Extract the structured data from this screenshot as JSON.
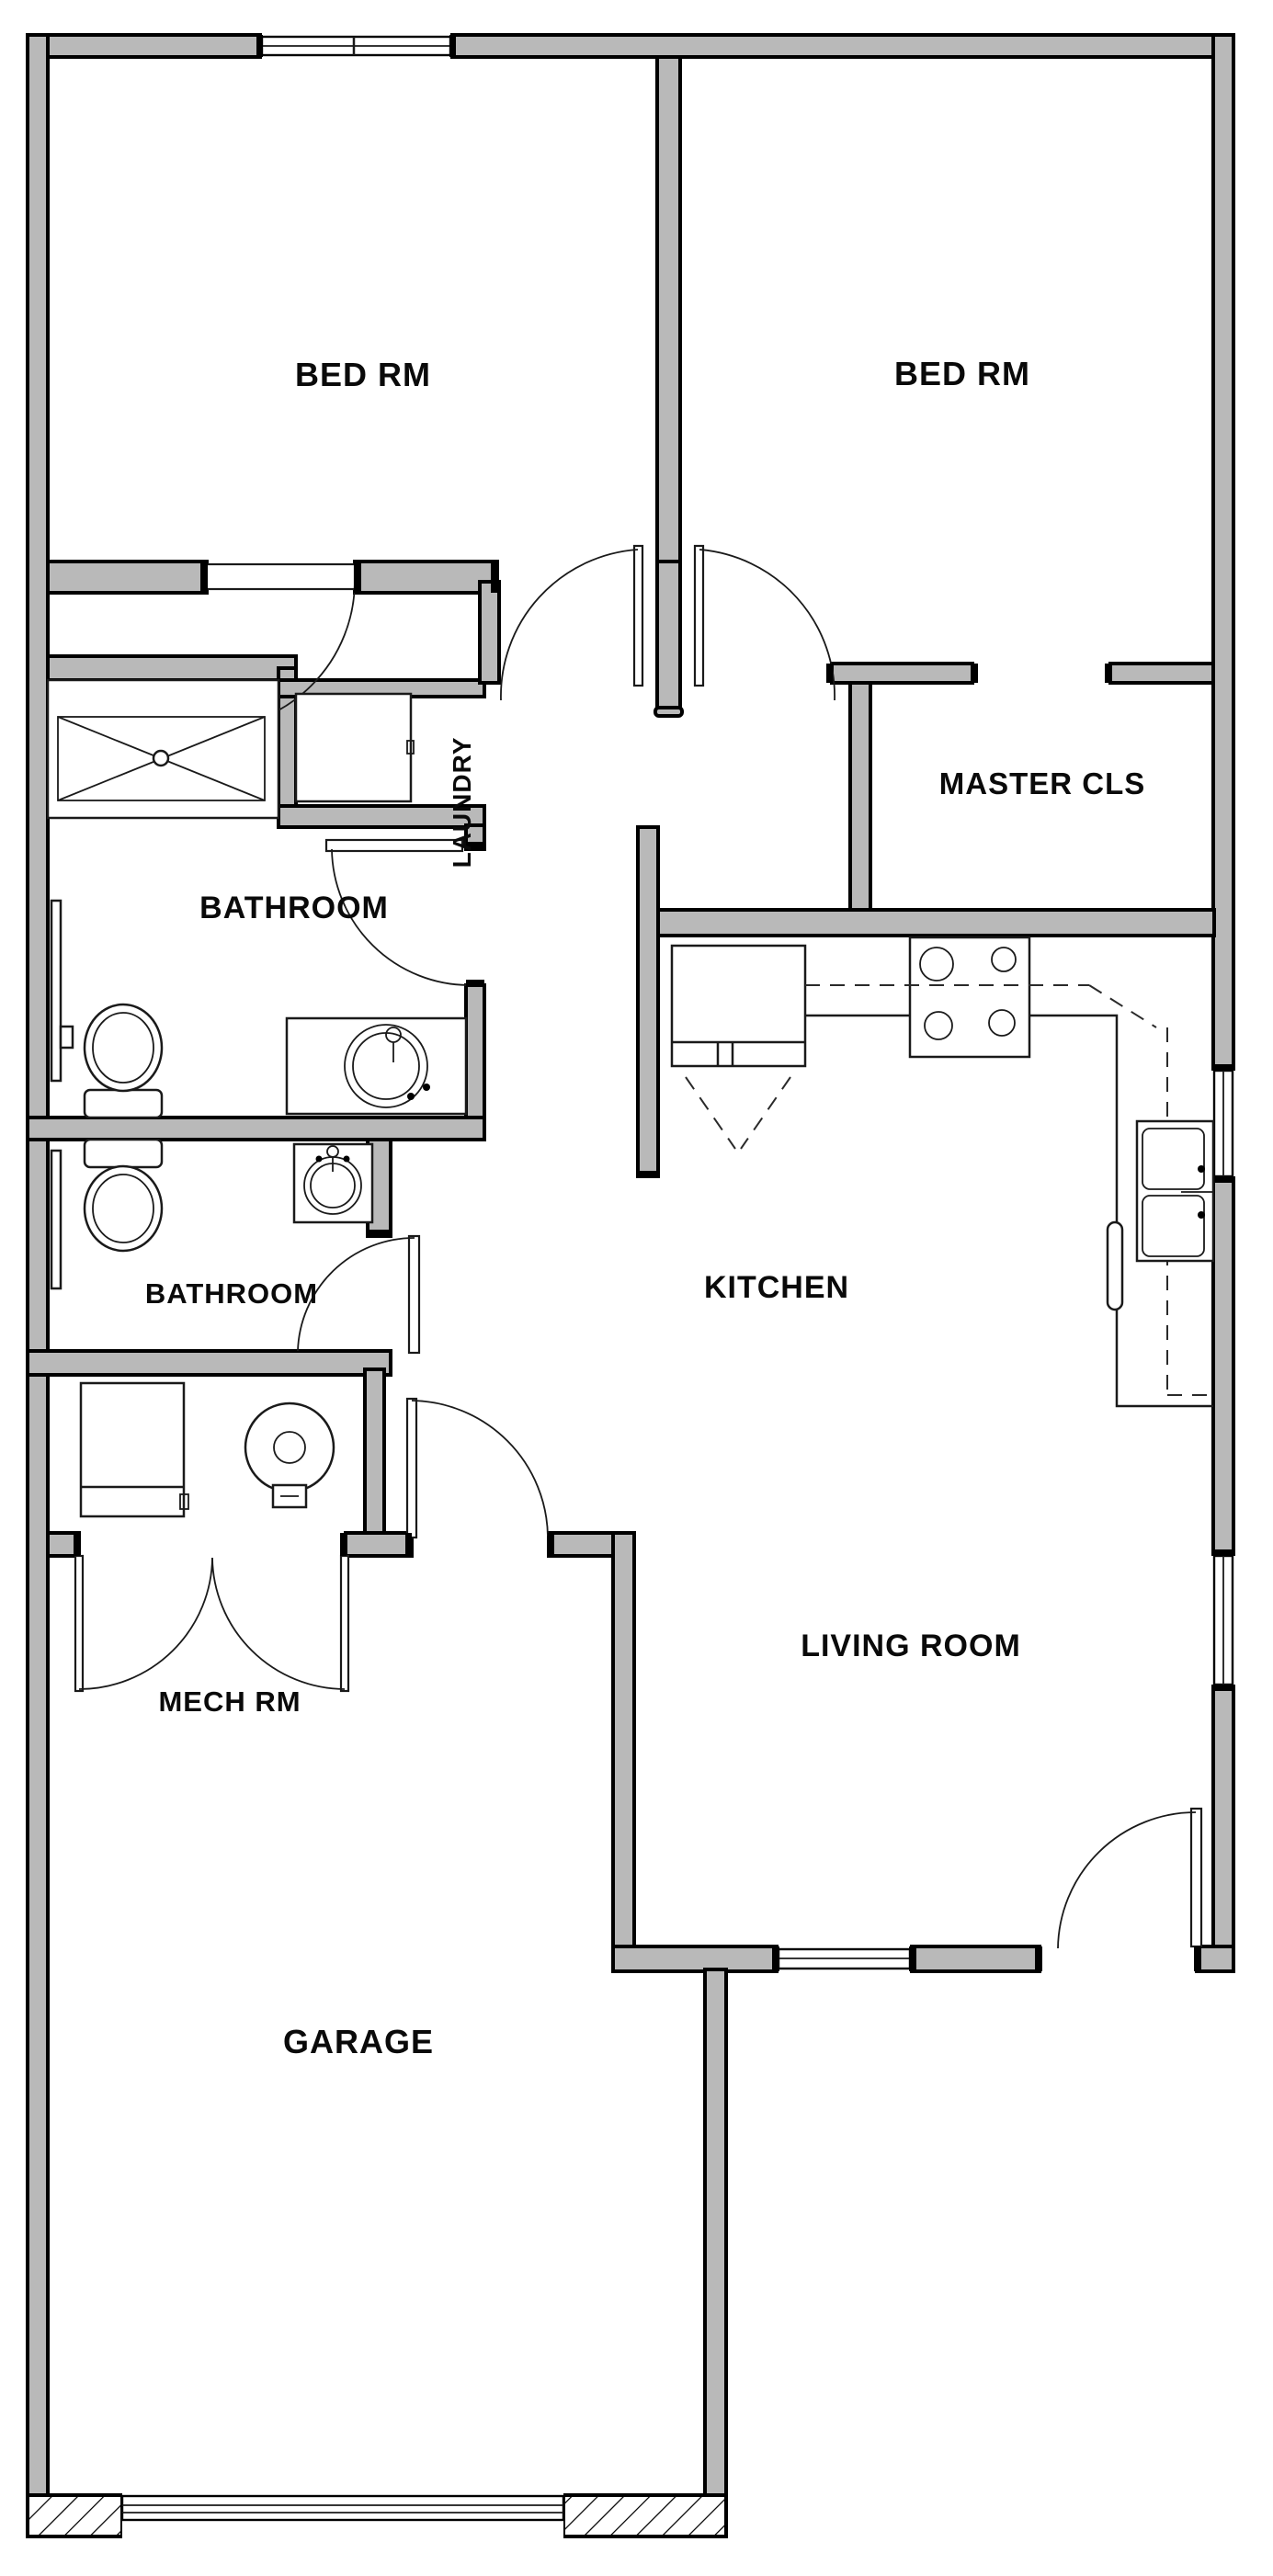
{
  "title": "Residential unit floor plan",
  "colors": {
    "wall_fill": "#b9b9b9",
    "wall_line": "#000000",
    "fixture_line": "#1a1a1a",
    "background": "#ffffff",
    "label_text": "#0a0a0a"
  },
  "rooms": {
    "bed1": {
      "label": "BED RM"
    },
    "bed2": {
      "label": "BED RM"
    },
    "laundry": {
      "label": "LAUNDRY"
    },
    "master_cls": {
      "label": "MASTER CLS"
    },
    "bath1": {
      "label": "BATHROOM"
    },
    "bath2": {
      "label": "BATHROOM"
    },
    "kitchen": {
      "label": "KITCHEN"
    },
    "living": {
      "label": "LIVING ROOM"
    },
    "mech": {
      "label": "MECH RM"
    },
    "garage": {
      "label": "GARAGE"
    }
  }
}
